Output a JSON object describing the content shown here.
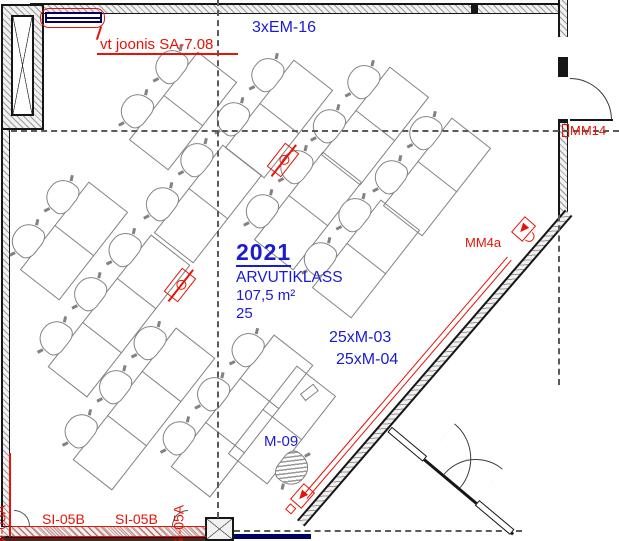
{
  "labels": {
    "em16": "3xEM-16",
    "sa708": "vt joonis SA-7.08",
    "mm14": "MM14",
    "mm4a": "MM4a",
    "room_number": "2021",
    "room_name": "ARVUTIKLASS",
    "room_area": "107,5 m²",
    "room_capacity": "25",
    "m03": "25xM-03",
    "m04": "25xM-04",
    "m09": "M-09",
    "si05b_left": "SI-05B",
    "si05b_right": "SI-05B",
    "si05a_left": "SI-05A",
    "si05a_mid": "SI-05A"
  },
  "colors": {
    "annotation_blue": "#1b1bd2",
    "annotation_red": "#e51408",
    "beam_navy": "#000060",
    "wall": "#161616",
    "furniture": "#828282"
  },
  "desks": {
    "rotation_deg": -52,
    "seat_pitch": 56,
    "bank_depth": 50,
    "banks": [
      {
        "x": 183,
        "y": 111,
        "seats": 2
      },
      {
        "x": 279,
        "y": 119,
        "seats": 2
      },
      {
        "x": 375,
        "y": 126,
        "seats": 2
      },
      {
        "x": 437,
        "y": 177,
        "seats": 2
      },
      {
        "x": 74,
        "y": 241,
        "seats": 2
      },
      {
        "x": 208,
        "y": 204,
        "seats": 2
      },
      {
        "x": 308,
        "y": 211,
        "seats": 2
      },
      {
        "x": 119,
        "y": 316,
        "seats": 3
      },
      {
        "x": 366,
        "y": 259,
        "seats": 2
      },
      {
        "x": 144,
        "y": 409,
        "seats": 3
      },
      {
        "x": 242,
        "y": 416,
        "seats": 3
      }
    ],
    "teacher_bank": {
      "x": 282,
      "y": 425,
      "seats": 2
    }
  },
  "floor_sockets": [
    {
      "x": 283,
      "y": 160
    },
    {
      "x": 180,
      "y": 285
    }
  ]
}
